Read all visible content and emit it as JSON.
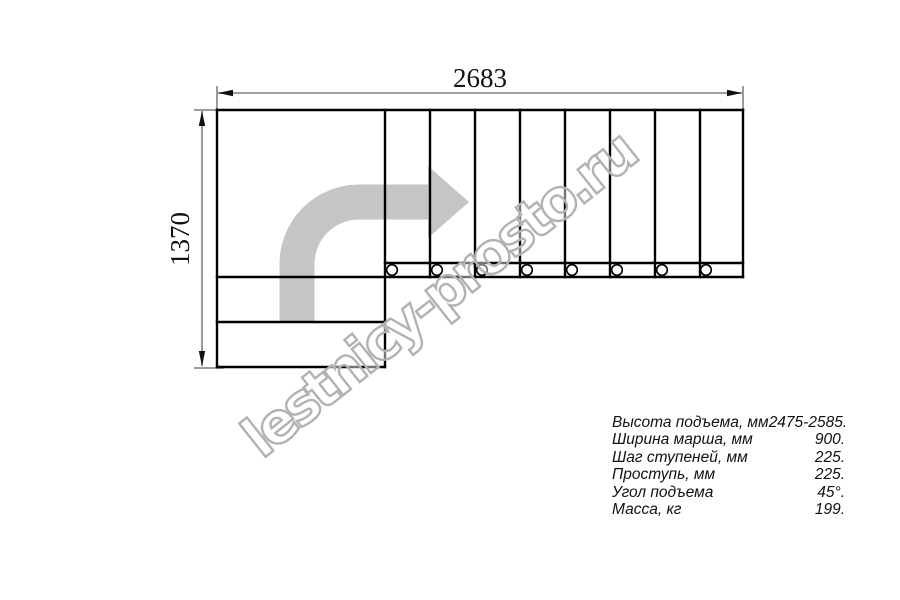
{
  "drawing": {
    "top_dimension_label": "2683",
    "left_dimension_label": "1370",
    "watermark_text": "lestnicy-prosto.ru"
  },
  "specs": {
    "rows": [
      {
        "label": "Высота подъема, мм",
        "value": "2475-2585."
      },
      {
        "label": "Ширина марша, мм",
        "value": "900."
      },
      {
        "label": "Шаг ступеней, мм",
        "value": "225."
      },
      {
        "label": "Проступь, мм",
        "value": "225."
      },
      {
        "label": "Угол подъема",
        "value": "45°."
      },
      {
        "label": "Масса, кг",
        "value": "199."
      }
    ]
  },
  "colors": {
    "line": "#000000",
    "dimension_line": "#8f8f8f",
    "direction_arrow": "#c5c5c5",
    "watermark_outline": "#b2b2b2",
    "background": "#ffffff"
  }
}
